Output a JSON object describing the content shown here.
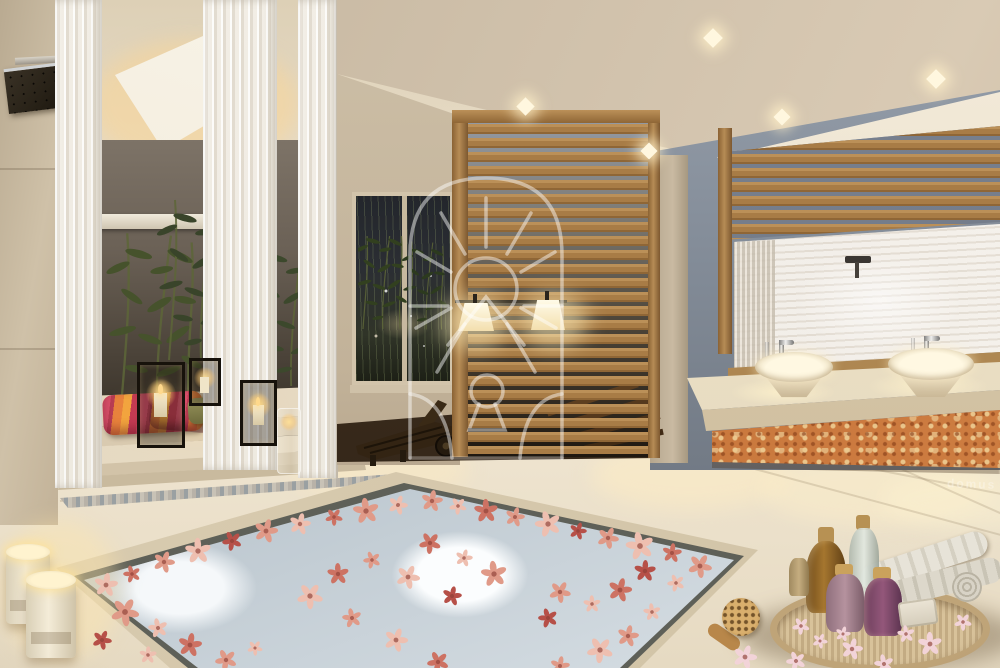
{
  "scene": {
    "kind": "architectural rendering of a luxury spa bathroom",
    "watermark": {
      "logo_icon": "arched-sun-keyhole-emblem",
      "brand_text": "domus"
    }
  },
  "palette": {
    "floor": "#e8ddc6",
    "ceiling": "#d3c5b0",
    "wall_beige": "#c9baa3",
    "wall_grey": "#7e8894",
    "wood_slat": "#b18756",
    "water_base": "#a9b7c2",
    "foam": "#f6f9fa",
    "damask": "#c5743b",
    "damask_hi": "#ecc98f",
    "curtain": "#efe9dd",
    "glow": "#ffe7b0",
    "candle_flame": "#ffd98c",
    "olive_pillow": "#8f8c52",
    "pillow_stripes": [
      "#d84f6a",
      "#e8823c",
      "#f2a43e",
      "#c43b52"
    ],
    "flower_colors": [
      "#eebfb0",
      "#e09a88",
      "#cd7263",
      "#b65048",
      "#f2d3d8"
    ]
  }
}
